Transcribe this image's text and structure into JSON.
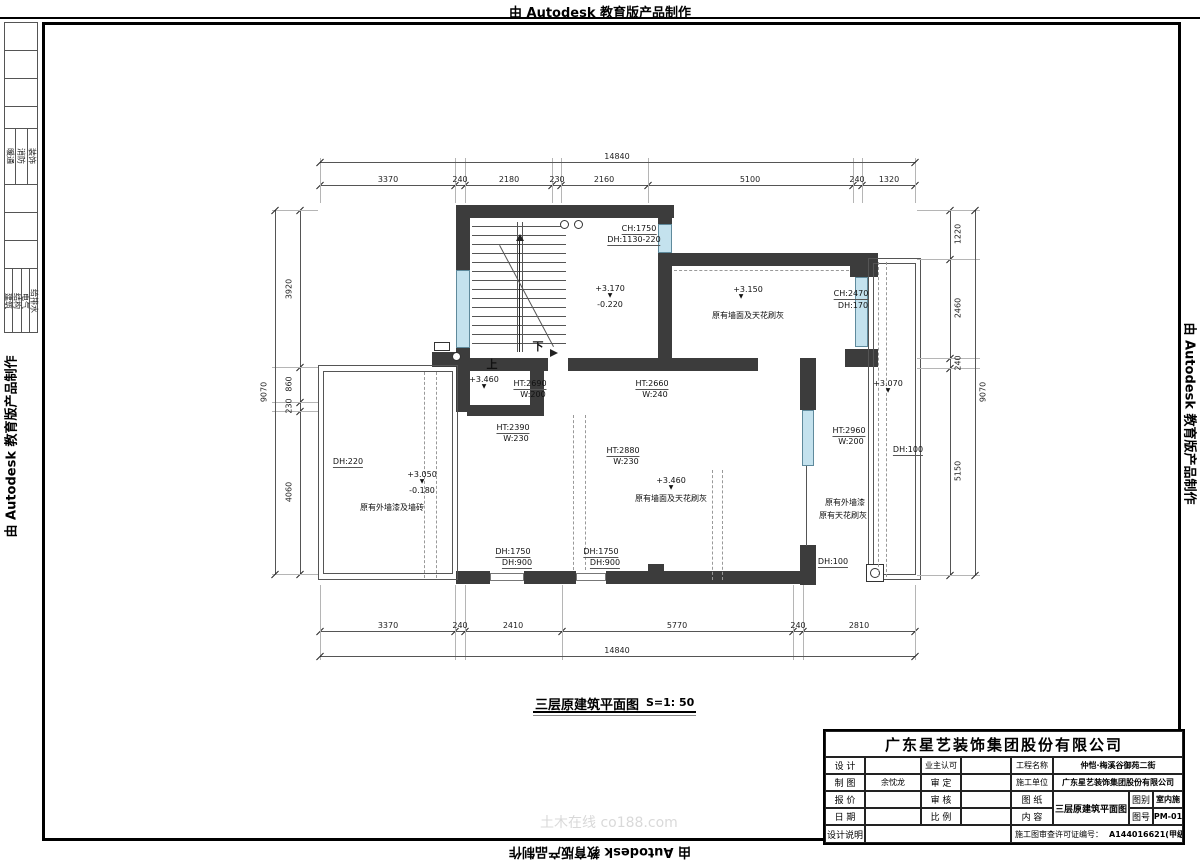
{
  "stamp_text": "由 Autodesk 教育版产品制作",
  "watermark": "土木在线 co188.com",
  "left_strip": {
    "group_a": [
      "暖通",
      "消防",
      "装饰"
    ],
    "group_b": [
      "建筑",
      "结构",
      "电气",
      "给排水"
    ]
  },
  "plan_title": {
    "name": "三层原建筑平面图",
    "scale": "S=1: 50"
  },
  "plan": {
    "annotations": [
      {
        "t": "CH:1750",
        "x": 639,
        "y": 224,
        "cls": "ul"
      },
      {
        "t": "DH:1130-220",
        "x": 634,
        "y": 235,
        "cls": "ul"
      },
      {
        "t": "+3.170",
        "x": 610,
        "y": 284
      },
      {
        "t": "▼",
        "x": 610,
        "y": 293,
        "cls": "tri"
      },
      {
        "t": "-0.220",
        "x": 610,
        "y": 300
      },
      {
        "t": "+3.150",
        "x": 748,
        "y": 285
      },
      {
        "t": "▼",
        "x": 741,
        "y": 294,
        "cls": "tri"
      },
      {
        "t": "原有墙面及天花刷灰",
        "x": 748,
        "y": 311
      },
      {
        "t": "CH:2470",
        "x": 851,
        "y": 289,
        "cls": "ul"
      },
      {
        "t": "DH:170",
        "x": 853,
        "y": 301
      },
      {
        "t": "上",
        "x": 492,
        "y": 360,
        "cls": "big"
      },
      {
        "t": "下",
        "x": 538,
        "y": 342,
        "cls": "big"
      },
      {
        "t": "+3.460",
        "x": 484,
        "y": 375
      },
      {
        "t": "▼",
        "x": 484,
        "y": 384,
        "cls": "tri"
      },
      {
        "t": "HT:2690",
        "x": 530,
        "y": 379,
        "cls": "ul"
      },
      {
        "t": "W:200",
        "x": 533,
        "y": 390
      },
      {
        "t": "HT:2660",
        "x": 652,
        "y": 379,
        "cls": "ul"
      },
      {
        "t": "W:240",
        "x": 655,
        "y": 390
      },
      {
        "t": "+3.070",
        "x": 888,
        "y": 379
      },
      {
        "t": "▼",
        "x": 888,
        "y": 388,
        "cls": "tri"
      },
      {
        "t": "HT:2390",
        "x": 513,
        "y": 423,
        "cls": "ul"
      },
      {
        "t": "W:230",
        "x": 516,
        "y": 434
      },
      {
        "t": "HT:2880",
        "x": 623,
        "y": 446,
        "cls": "ul"
      },
      {
        "t": "W:230",
        "x": 626,
        "y": 457
      },
      {
        "t": "HT:2960",
        "x": 849,
        "y": 426,
        "cls": "ul"
      },
      {
        "t": "W:200",
        "x": 851,
        "y": 437
      },
      {
        "t": "DH:100",
        "x": 908,
        "y": 445,
        "cls": "ul"
      },
      {
        "t": "DH:220",
        "x": 348,
        "y": 457,
        "cls": "ul"
      },
      {
        "t": "+3.050",
        "x": 422,
        "y": 470
      },
      {
        "t": "▼",
        "x": 422,
        "y": 479,
        "cls": "tri"
      },
      {
        "t": "-0.180",
        "x": 422,
        "y": 486
      },
      {
        "t": "原有外墙漆及墙砖",
        "x": 392,
        "y": 503
      },
      {
        "t": "+3.460",
        "x": 671,
        "y": 476
      },
      {
        "t": "▼",
        "x": 671,
        "y": 485,
        "cls": "tri"
      },
      {
        "t": "原有墙面及天花刷灰",
        "x": 671,
        "y": 494
      },
      {
        "t": "原有外墙漆",
        "x": 845,
        "y": 498
      },
      {
        "t": "原有天花刷灰",
        "x": 843,
        "y": 511
      },
      {
        "t": "DH:1750",
        "x": 513,
        "y": 547,
        "cls": "ul"
      },
      {
        "t": "DH:900",
        "x": 517,
        "y": 558,
        "cls": "ul"
      },
      {
        "t": "DH:1750",
        "x": 601,
        "y": 547,
        "cls": "ul"
      },
      {
        "t": "DH:900",
        "x": 605,
        "y": 558,
        "cls": "ul"
      },
      {
        "t": "DH:100",
        "x": 833,
        "y": 557,
        "cls": "ul"
      }
    ]
  },
  "dims": {
    "chains": [
      {
        "dir": "h",
        "y": 185,
        "x1": 320,
        "x2": 915,
        "off": -10,
        "ext": [
          158,
          203
        ],
        "ticks": [
          320,
          455,
          465,
          552,
          561,
          648,
          853,
          862,
          915
        ],
        "labels": [
          {
            "t": "3370",
            "c": 388
          },
          {
            "t": "240",
            "c": 460
          },
          {
            "t": "2180",
            "c": 509
          },
          {
            "t": "230",
            "c": 557
          },
          {
            "t": "2160",
            "c": 604
          },
          {
            "t": "5100",
            "c": 750
          },
          {
            "t": "240",
            "c": 857
          },
          {
            "t": "1320",
            "c": 889
          }
        ]
      },
      {
        "dir": "h",
        "y": 162,
        "x1": 320,
        "x2": 915,
        "off": -10,
        "ticks": [
          320,
          915
        ],
        "labels": [
          {
            "t": "14840",
            "c": 617
          }
        ]
      },
      {
        "dir": "h",
        "y": 631,
        "x1": 320,
        "x2": 915,
        "off": -10,
        "ext": [
          585,
          660
        ],
        "ticks": [
          320,
          455,
          465,
          562,
          793,
          803,
          915
        ],
        "labels": [
          {
            "t": "3370",
            "c": 388
          },
          {
            "t": "240",
            "c": 460
          },
          {
            "t": "2410",
            "c": 513
          },
          {
            "t": "5770",
            "c": 677
          },
          {
            "t": "240",
            "c": 798
          },
          {
            "t": "2810",
            "c": 859
          }
        ]
      },
      {
        "dir": "h",
        "y": 656,
        "x1": 320,
        "x2": 915,
        "off": -10,
        "ticks": [
          320,
          915
        ],
        "labels": [
          {
            "t": "14840",
            "c": 617
          }
        ]
      },
      {
        "dir": "v",
        "x": 300,
        "y1": 210,
        "y2": 574,
        "off": -11,
        "ext": [
          272,
          318
        ],
        "ticks": [
          210,
          367,
          402,
          411,
          574
        ],
        "labels": [
          {
            "t": "3920",
            "c": 289
          },
          {
            "t": "860",
            "c": 384
          },
          {
            "t": "230",
            "c": 406
          },
          {
            "t": "4060",
            "c": 492
          }
        ]
      },
      {
        "dir": "v",
        "x": 275,
        "y1": 210,
        "y2": 574,
        "off": -11,
        "ticks": [
          210,
          574
        ],
        "labels": [
          {
            "t": "9070",
            "c": 392
          }
        ]
      },
      {
        "dir": "v",
        "x": 950,
        "y1": 210,
        "y2": 575,
        "off": 8,
        "ext": [
          917,
          980
        ],
        "ticks": [
          210,
          259,
          358,
          368,
          575
        ],
        "labels": [
          {
            "t": "1220",
            "c": 234
          },
          {
            "t": "2460",
            "c": 308
          },
          {
            "t": "240",
            "c": 363
          },
          {
            "t": "5150",
            "c": 471
          }
        ]
      },
      {
        "dir": "v",
        "x": 975,
        "y1": 210,
        "y2": 575,
        "off": 8,
        "ticks": [
          210,
          575
        ],
        "labels": [
          {
            "t": "9070",
            "c": 392
          }
        ]
      }
    ]
  },
  "titleblock": {
    "company": "广东星艺装饰集团股份有限公司",
    "design_label": "设 计",
    "design_value": "",
    "draft_label": "制 图",
    "draft_value": "余忱龙",
    "quote_label": "报 价",
    "quote_value": "",
    "date_label": "日 期",
    "date_value": "",
    "owner_label": "业主认可",
    "owner_value": "",
    "approve_label": "审 定",
    "approve_value": "",
    "check_label": "审 核",
    "check_value": "",
    "ratio_label": "比 例",
    "ratio_value": "",
    "project_label": "工程名称",
    "project_value": "仲恺·梅溪谷御苑二街",
    "builder_label": "施工单位",
    "builder_value": "广东星艺装饰集团股份有限公司",
    "sheet_label": "图 纸",
    "content_label": "内 容",
    "sheet_content": "三层原建筑平面图",
    "type_label": "图别",
    "type_value": "室内施",
    "no_label": "图号",
    "no_value": "PM-01",
    "notes_label": "设计说明",
    "cert_label": "施工图审查许可证编号：",
    "cert_value": "A144016621(甲级)"
  }
}
